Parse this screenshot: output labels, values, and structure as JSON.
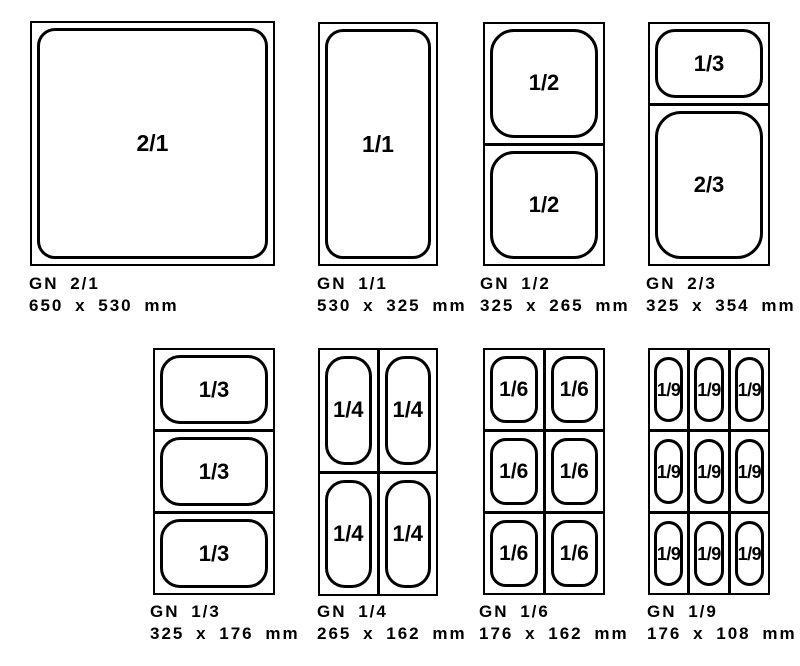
{
  "page": {
    "background": "#ffffff",
    "ink": "#000000"
  },
  "pans": [
    {
      "name": "GN 2/1",
      "dims": "650 x 530 mm",
      "cells": [
        "2/1"
      ]
    },
    {
      "name": "GN 1/1",
      "dims": "530 x 325 mm",
      "cells": [
        "1/1"
      ]
    },
    {
      "name": "GN 1/2",
      "dims": "325 x 265 mm",
      "cells": [
        "1/2",
        "1/2"
      ]
    },
    {
      "name": "GN 2/3",
      "dims": "325 x 354 mm",
      "cells": [
        "1/3",
        "2/3"
      ]
    },
    {
      "name": "GN 1/3",
      "dims": "325 x 176 mm",
      "cells": [
        "1/3",
        "1/3",
        "1/3"
      ]
    },
    {
      "name": "GN 1/4",
      "dims": "265 x 162 mm",
      "cells": [
        "1/4",
        "1/4",
        "1/4",
        "1/4"
      ]
    },
    {
      "name": "GN 1/6",
      "dims": "176 x 162 mm",
      "cells": [
        "1/6",
        "1/6",
        "1/6",
        "1/6",
        "1/6",
        "1/6"
      ]
    },
    {
      "name": "GN 1/9",
      "dims": "176 x 108 mm",
      "cells": [
        "1/9",
        "1/9",
        "1/9",
        "1/9",
        "1/9",
        "1/9",
        "1/9",
        "1/9",
        "1/9"
      ]
    }
  ]
}
